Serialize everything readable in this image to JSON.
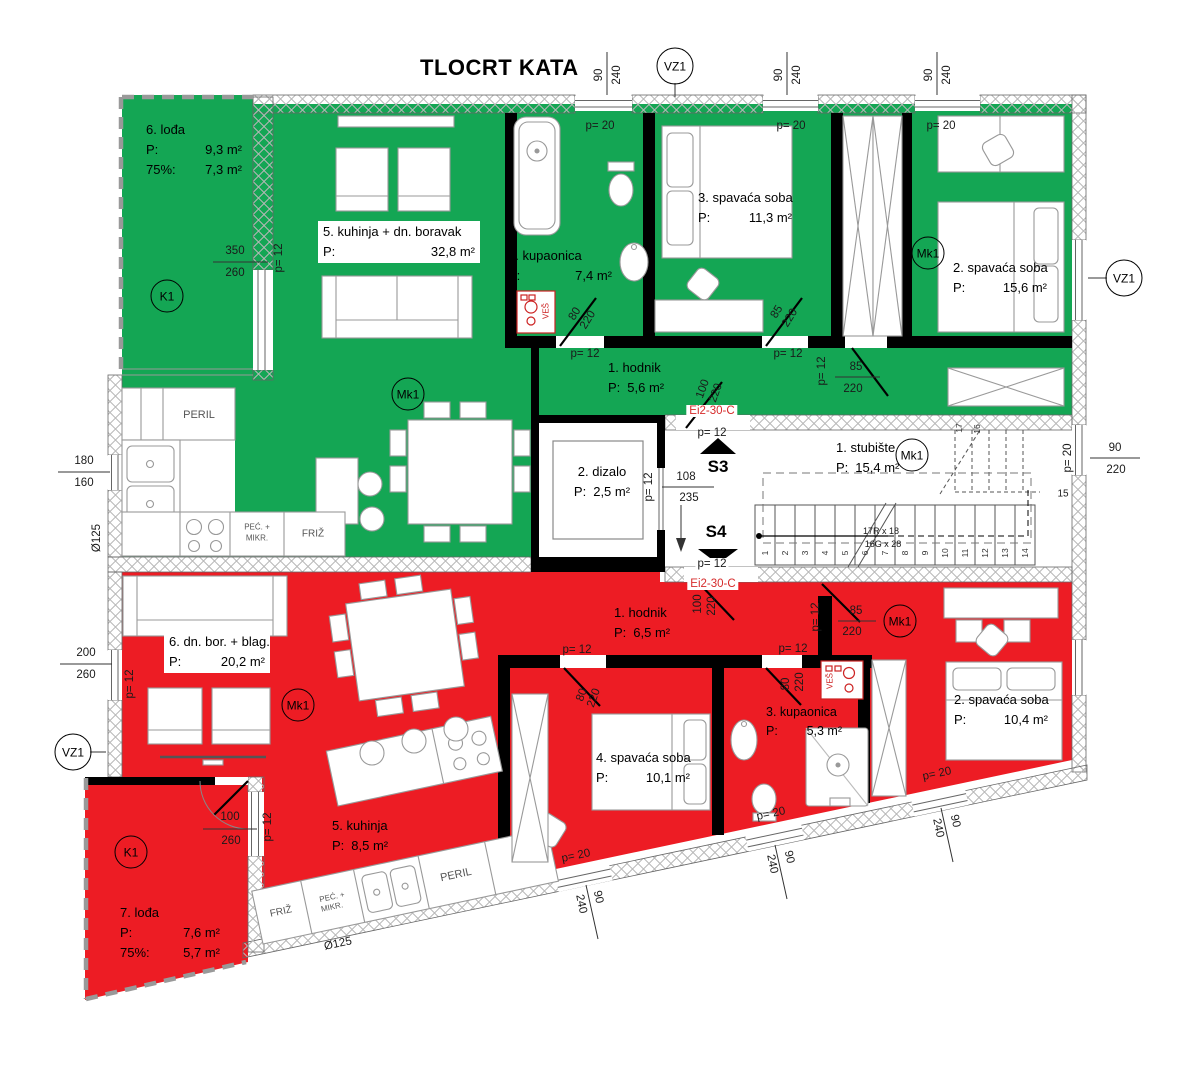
{
  "title": "TLOCRT KATA",
  "colors": {
    "green": "#14a654",
    "red": "#ed1c24",
    "fire_label": "#d62b2b",
    "wall": "#000000"
  },
  "labels": {
    "p": "P:",
    "p75": "75%:"
  },
  "green_apartment": {
    "loggia": {
      "name": "6. lođa",
      "area": "9,3 m²",
      "area75": "7,3 m²"
    },
    "kitchen_living": {
      "name": "5. kuhinja + dn. boravak",
      "area": "32,8 m²"
    },
    "bathroom": {
      "name": "4. kupaonica",
      "area": "7,4 m²"
    },
    "bedroom3": {
      "name": "3. spavaća soba",
      "area": "11,3 m²"
    },
    "hall": {
      "name": "1. hodnik",
      "area": "5,6 m²"
    },
    "bedroom2": {
      "name": "2. spavaća soba",
      "area": "15,6 m²"
    }
  },
  "red_apartment": {
    "living_dining": {
      "name": "6. dn. bor. + blag.",
      "area": "20,2 m²"
    },
    "hall": {
      "name": "1. hodnik",
      "area": "6,5 m²"
    },
    "bedroom4": {
      "name": "4. spavaća soba",
      "area": "10,1 m²"
    },
    "bathroom": {
      "name": "3. kupaonica",
      "area": "5,3 m²"
    },
    "bedroom2": {
      "name": "2. spavaća soba",
      "area": "10,4 m²"
    },
    "kitchen": {
      "name": "5. kuhinja",
      "area": "8,5 m²"
    },
    "loggia": {
      "name": "7. lođa",
      "area": "7,6 m²",
      "area75": "5,7 m²"
    }
  },
  "core": {
    "stairs": {
      "name": "1. stubište",
      "area": "15,4 m²"
    },
    "elevator": {
      "name": "2. dizalo",
      "area": "2,5 m²"
    },
    "section_up": "S3",
    "section_down": "S4",
    "fire_door": "Ei2-30-C",
    "riser_spec": "17R x 18",
    "going_spec": "16G x 28",
    "step_numbers": [
      "1",
      "2",
      "3",
      "4",
      "5",
      "6",
      "7",
      "8",
      "9",
      "10",
      "11",
      "12",
      "13",
      "14"
    ],
    "n15": "15",
    "n16": "16",
    "n17": "17"
  },
  "markers": {
    "k1": "K1",
    "vz1": "VZ1",
    "mk1": "Mk1"
  },
  "appliances": {
    "dishwasher": "PERIL",
    "fridge": "FRIŽ",
    "oven1": "PEĆ. +",
    "oven2": "MIKR.",
    "washer": "VEŠ"
  },
  "dims": {
    "d80": "80",
    "d85": "85",
    "d90": "90",
    "d100": "100",
    "d108": "108",
    "d160": "160",
    "d180": "180",
    "d200": "200",
    "d220": "220",
    "d235": "235",
    "d240": "240",
    "d260": "260",
    "d350": "350",
    "p12": "p= 12",
    "p20": "p= 20",
    "dia125": "Ø125"
  }
}
